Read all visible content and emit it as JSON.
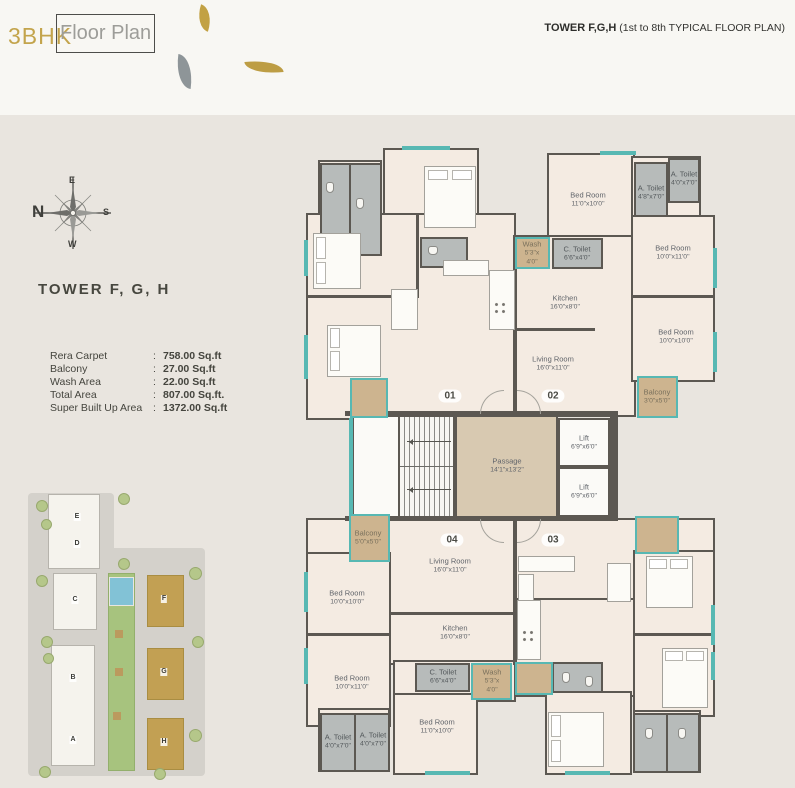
{
  "header": {
    "title_prefix": "3BHK",
    "title_suffix": "Floor Plan",
    "note_bold": "TOWER F,G,H",
    "note_rest": " (1st to 8th TYPICAL FLOOR PLAN)"
  },
  "compass": {
    "n": "N",
    "e": "E",
    "s": "S",
    "w": "W"
  },
  "tower_heading": "TOWER  F, G, H",
  "area_table": {
    "separator": ":",
    "rows": [
      {
        "label": "Rera Carpet",
        "value": "758.00 Sq.ft"
      },
      {
        "label": "Balcony",
        "value": "27.00 Sq.ft"
      },
      {
        "label": "Wash Area",
        "value": "22.00 Sq.ft"
      },
      {
        "label": "Total Area",
        "value": "807.00 Sq.ft."
      },
      {
        "label": "Super Built Up Area",
        "value": "1372.00 Sq.ft"
      }
    ]
  },
  "site_plan": {
    "buildings": [
      "E",
      "D",
      "C",
      "B",
      "A",
      "F",
      "G",
      "H"
    ]
  },
  "floor_plan": {
    "unit01": {
      "number": "01"
    },
    "unit02": {
      "number": "02",
      "bedroom_top": {
        "name": "Bed Room",
        "dim": "11'0\"x10'0\""
      },
      "a_toilet_inner": {
        "name": "A. Toilet",
        "dim": "4'8\"x7'0\""
      },
      "a_toilet_corner": {
        "name": "A. Toilet",
        "dim": "4'0\"x7'0\""
      },
      "wash": {
        "name": "Wash",
        "dim1": "5'3\"x",
        "dim2": "4'0\""
      },
      "c_toilet": {
        "name": "C. Toilet",
        "dim": "6'6\"x4'0\""
      },
      "bedroom_right_upper": {
        "name": "Bed Room",
        "dim": "10'0\"x11'0\""
      },
      "kitchen": {
        "name": "Kitchen",
        "dim": "16'0\"x8'0\""
      },
      "bedroom_right_lower": {
        "name": "Bed Room",
        "dim": "10'0\"x10'0\""
      },
      "living": {
        "name": "Living Room",
        "dim": "16'0\"x11'0\""
      },
      "balcony": {
        "name": "Balcony",
        "dim": "3'0\"x5'0\""
      }
    },
    "unit03": {
      "number": "03"
    },
    "unit04": {
      "number": "04",
      "living": {
        "name": "Living Room",
        "dim": "16'0\"x11'0\""
      },
      "bedroom_left_upper": {
        "name": "Bed Room",
        "dim": "10'0\"x10'0\""
      },
      "kitchen": {
        "name": "Kitchen",
        "dim": "16'0\"x8'0\""
      },
      "bedroom_left_lower": {
        "name": "Bed Room",
        "dim": "10'0\"x11'0\""
      },
      "c_toilet": {
        "name": "C. Toilet",
        "dim": "6'6\"x4'0\""
      },
      "wash": {
        "name": "Wash",
        "dim1": "5'3\"x",
        "dim2": "4'0\""
      },
      "a_toilet_left": {
        "name": "A. Toilet",
        "dim": "4'0\"x7'0\""
      },
      "a_toilet_right": {
        "name": "A. Toilet",
        "dim": "4'0\"x7'0\""
      },
      "bedroom_bottom": {
        "name": "Bed Room",
        "dim": "11'0\"x10'0\""
      },
      "balcony": {
        "name": "Balcony",
        "dim": "5'0\"x5'0\""
      }
    },
    "core": {
      "up": "Up",
      "dn": "Dn",
      "passage": {
        "name": "Passage",
        "dim": "14'1\"x13'2\""
      },
      "lift1": {
        "name": "Lift",
        "dim": "6'9\"x6'0\""
      },
      "lift2": {
        "name": "Lift",
        "dim": "6'9\"x6'0\""
      }
    }
  }
}
